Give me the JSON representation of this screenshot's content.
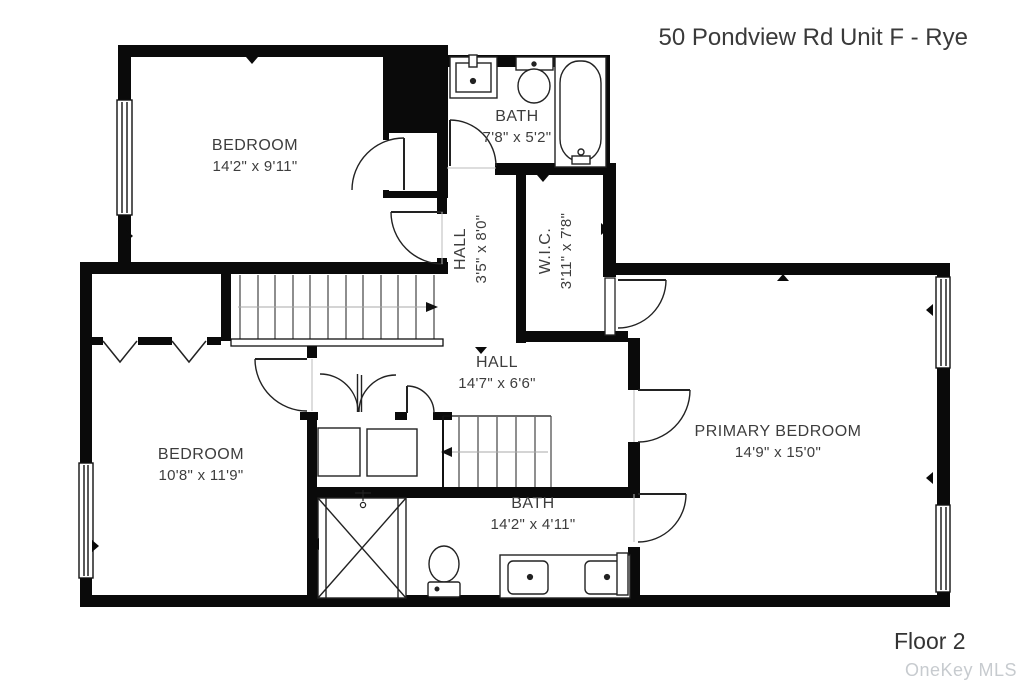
{
  "title": "50 Pondview Rd Unit F - Rye",
  "floor_label": "Floor 2",
  "watermark": "OneKey MLS",
  "rooms": {
    "bedroom1": {
      "name": "BEDROOM",
      "dims": "14'2\" x 9'11\""
    },
    "bath_top": {
      "name": "BATH",
      "dims": "7'8\" x 5'2\""
    },
    "hall_upper": {
      "name": "HALL",
      "dims": "3'5\" x 8'0\""
    },
    "wic": {
      "name": "W.I.C.",
      "dims": "3'11\" x 7'8\""
    },
    "hall_main": {
      "name": "HALL",
      "dims": "14'7\" x 6'6\""
    },
    "bedroom2": {
      "name": "BEDROOM",
      "dims": "10'8\" x 11'9\""
    },
    "primary": {
      "name": "PRIMARY BEDROOM",
      "dims": "14'9\" x 15'0\""
    },
    "bath_main": {
      "name": "BATH",
      "dims": "14'2\" x 4'11\""
    }
  },
  "colors": {
    "wall": "#0a0a0a",
    "line": "#222222",
    "text": "#3d3d3d",
    "watermark": "#c7cbcf"
  }
}
